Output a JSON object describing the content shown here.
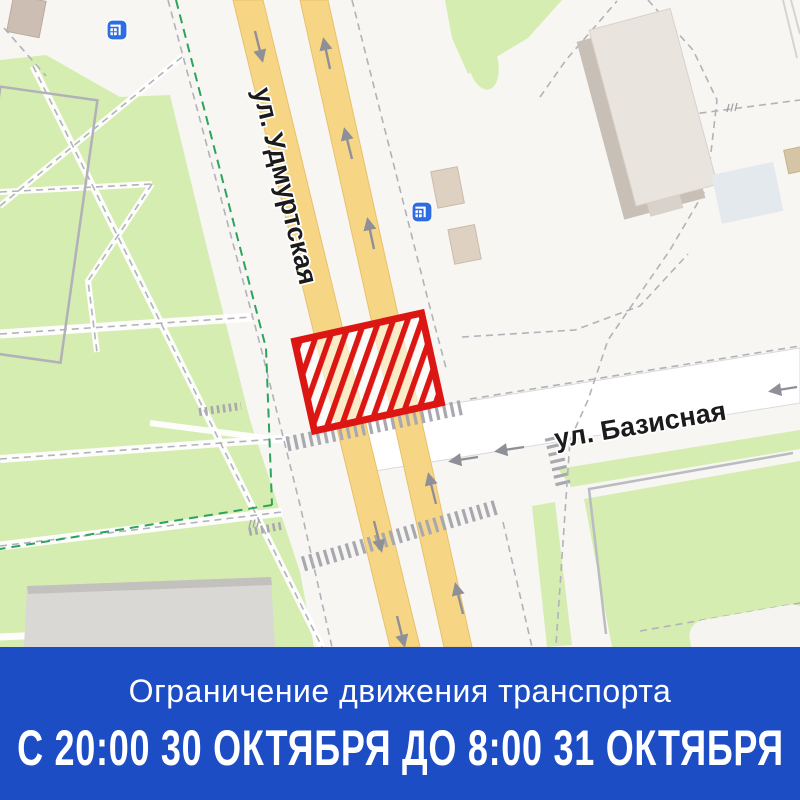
{
  "map": {
    "streets": {
      "udmurtskaya": "ул. Удмуртская",
      "bazisnaya": "ул. Базисная"
    },
    "icons": {
      "bus_stop": "transport-stop-icon"
    },
    "colors": {
      "background": "#f7f6f2",
      "park_green": "#d6edb1",
      "road_yellow": "#f6d685",
      "road_yellow_border": "#e9c06b",
      "closure_red": "#dc1713",
      "bus_icon_blue": "#2e6ce2",
      "banner_blue": "#1c4dc5",
      "crosswalk_gray": "#a8a8b0",
      "route_green_dash": "#2da35c"
    }
  },
  "banner": {
    "line1": "Ограничение движения транспорта",
    "line2": "С 20:00 30 ОКТЯБРЯ ДО 8:00 31 ОКТЯБРЯ"
  }
}
